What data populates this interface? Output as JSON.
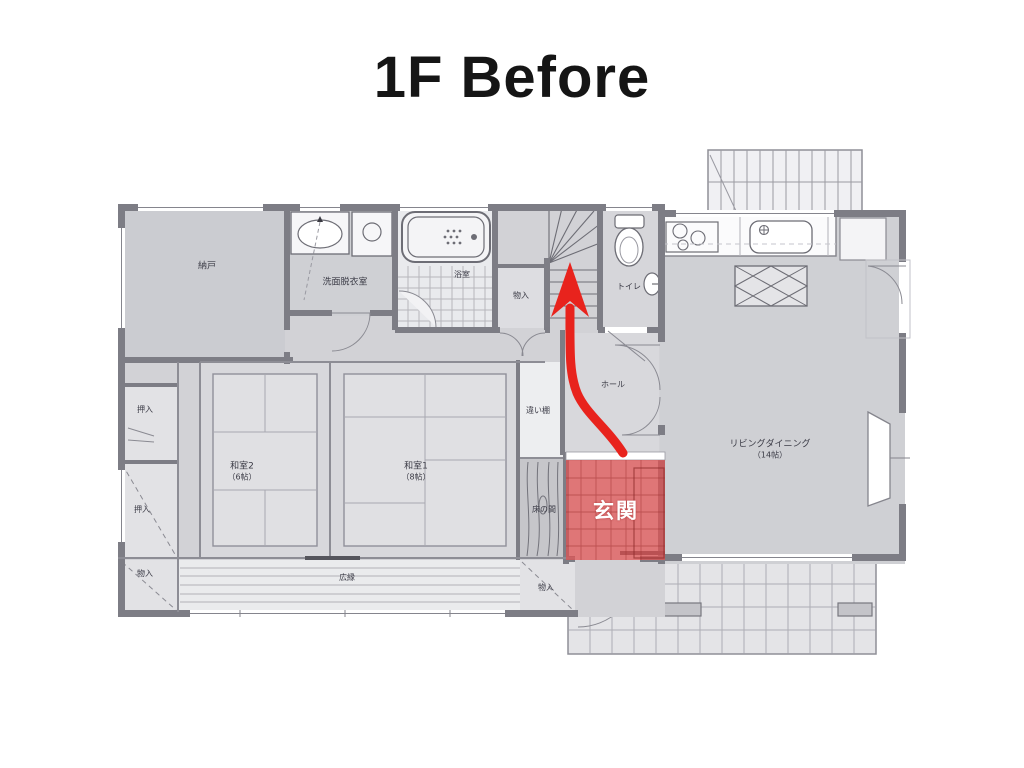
{
  "title": "1F Before",
  "rooms": {
    "nando": {
      "label": "納戸"
    },
    "senmen": {
      "label": "洗面脱衣室"
    },
    "bath": {
      "label": "浴室"
    },
    "stairs_storage": {
      "label": "物入"
    },
    "toilet": {
      "label": "トイレ"
    },
    "living": {
      "label": "リビングダイニング",
      "size": "（14帖）"
    },
    "washitsu2": {
      "label": "和室2",
      "size": "（6帖）"
    },
    "washitsu1": {
      "label": "和室1",
      "size": "（8帖）"
    },
    "chigaidana": {
      "label": "違い棚"
    },
    "tokonoma": {
      "label": "床の間"
    },
    "genkan": {
      "label": "玄関"
    },
    "hall": {
      "label": "ホール"
    },
    "hiroen": {
      "label": "広縁"
    },
    "oshiire_upper": {
      "label": "押入"
    },
    "oshiire_lower": {
      "label": "押入"
    },
    "monoire_left": {
      "label": "物入"
    },
    "monoire_right": {
      "label": "物入"
    }
  },
  "annotations": {
    "highlight_color": "#e25050",
    "arrow_color": "#e8231d"
  }
}
